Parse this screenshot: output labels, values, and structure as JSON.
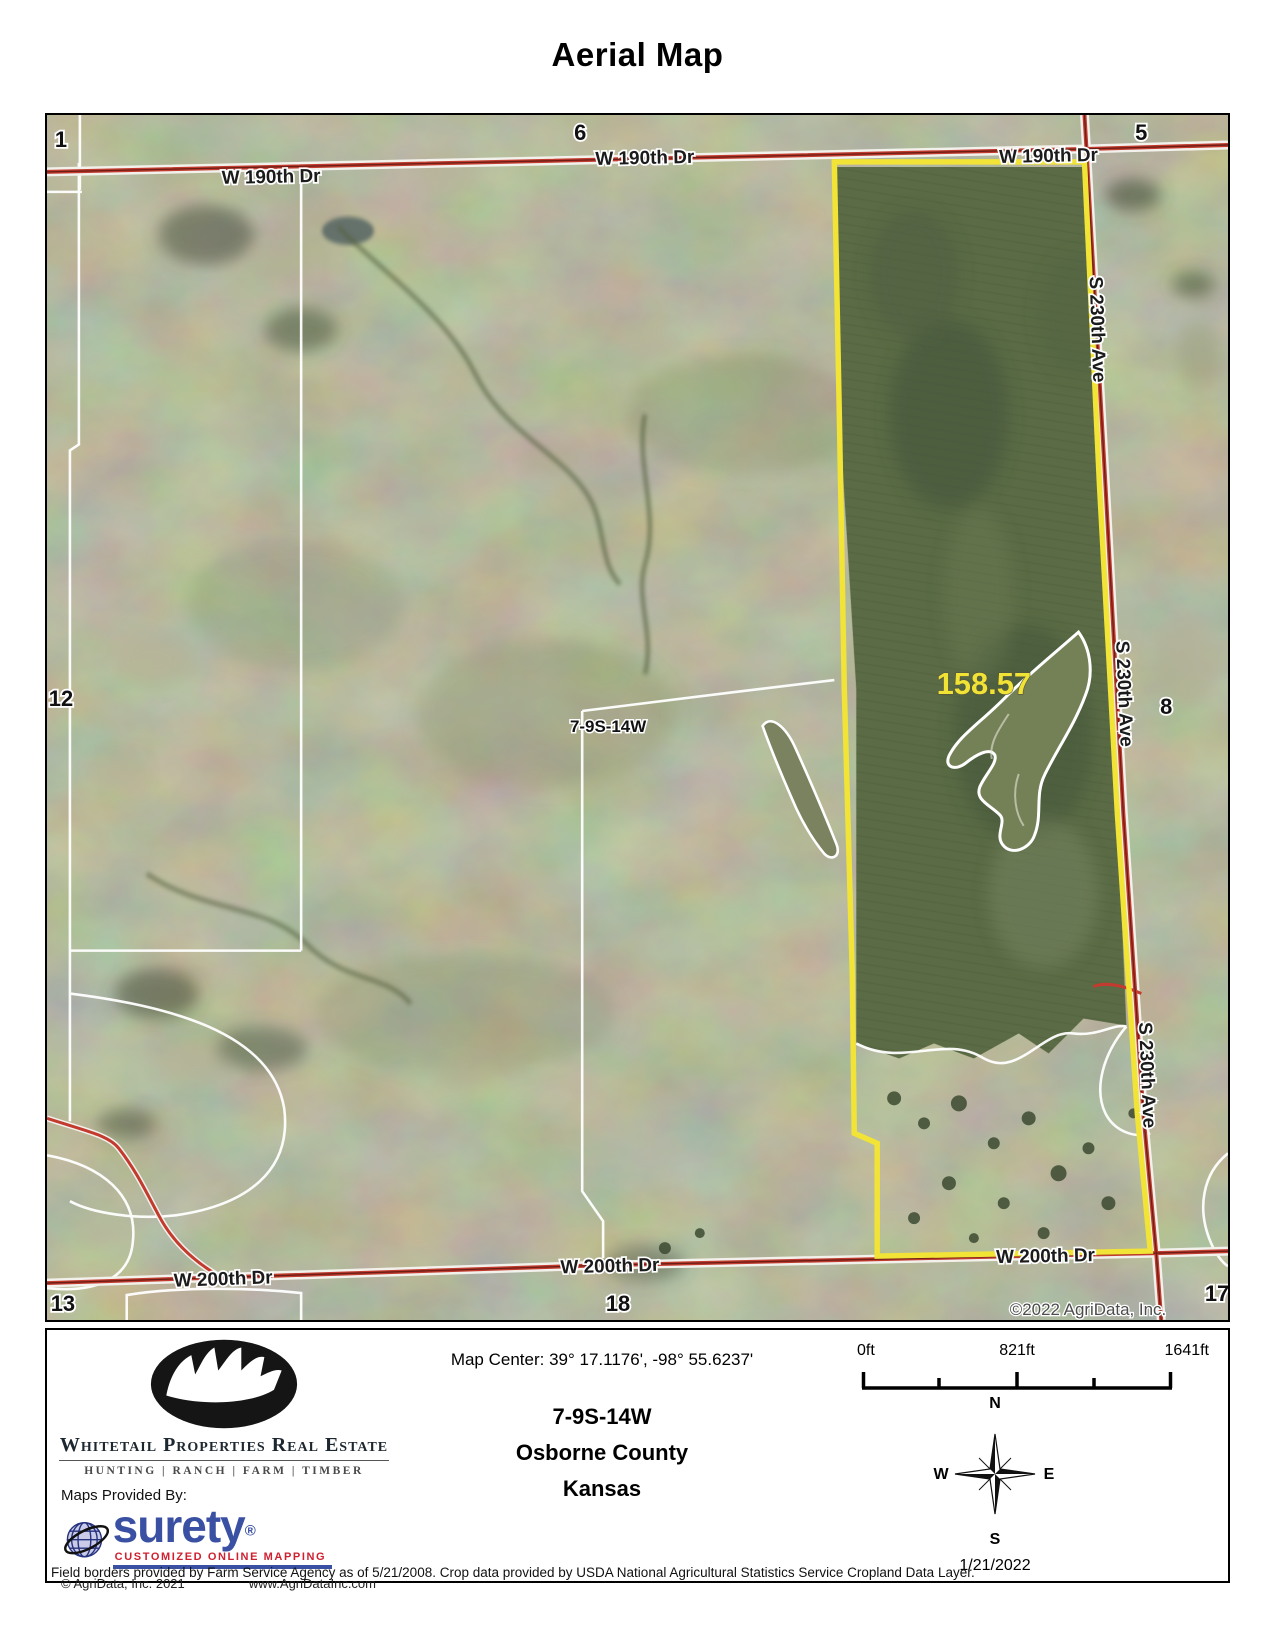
{
  "title": "Aerial Map",
  "map": {
    "roads": {
      "w190": "W 190th Dr",
      "s230": "S 230th Ave",
      "w200": "W 200th Dr"
    },
    "sections": {
      "s1": "1",
      "s5": "5",
      "s6": "6",
      "s8": "8",
      "s12": "12",
      "s13": "13",
      "s17": "17",
      "s18": "18"
    },
    "township_label": "7-9S-14W",
    "acreage": "158.57",
    "copyright": "©2022 AgriData, Inc.",
    "colors": {
      "parcel_boundary": "#f2e337",
      "road_red": "#c23b2e",
      "acreage_text": "#f0e335"
    }
  },
  "footer": {
    "map_center": "Map Center: 39° 17.1176',  -98° 55.6237'",
    "legal": {
      "township": "7-9S-14W",
      "county": "Osborne County",
      "state": "Kansas"
    },
    "scale_bar": {
      "start": "0ft",
      "middle": "821ft",
      "end": "1641ft"
    },
    "compass": {
      "north": "N",
      "east": "E",
      "south": "S",
      "west": "W"
    },
    "date": "1/21/2022",
    "branding": {
      "company": "Whitetail Properties Real Estate",
      "tagline": "HUNTING | RANCH | FARM | TIMBER",
      "maps_provided_by": "Maps Provided By:",
      "surety_name": "surety",
      "surety_reg": "®",
      "surety_tagline": "CUSTOMIZED ONLINE MAPPING",
      "agridata_copyright": "© AgriData, Inc. 2021",
      "agridata_website": "www.AgriDataInc.com"
    },
    "disclaimer": "Field borders provided by Farm Service Agency as of 5/21/2008. Crop data provided by USDA National Agricultural Statistics Service Cropland Data Layer."
  }
}
